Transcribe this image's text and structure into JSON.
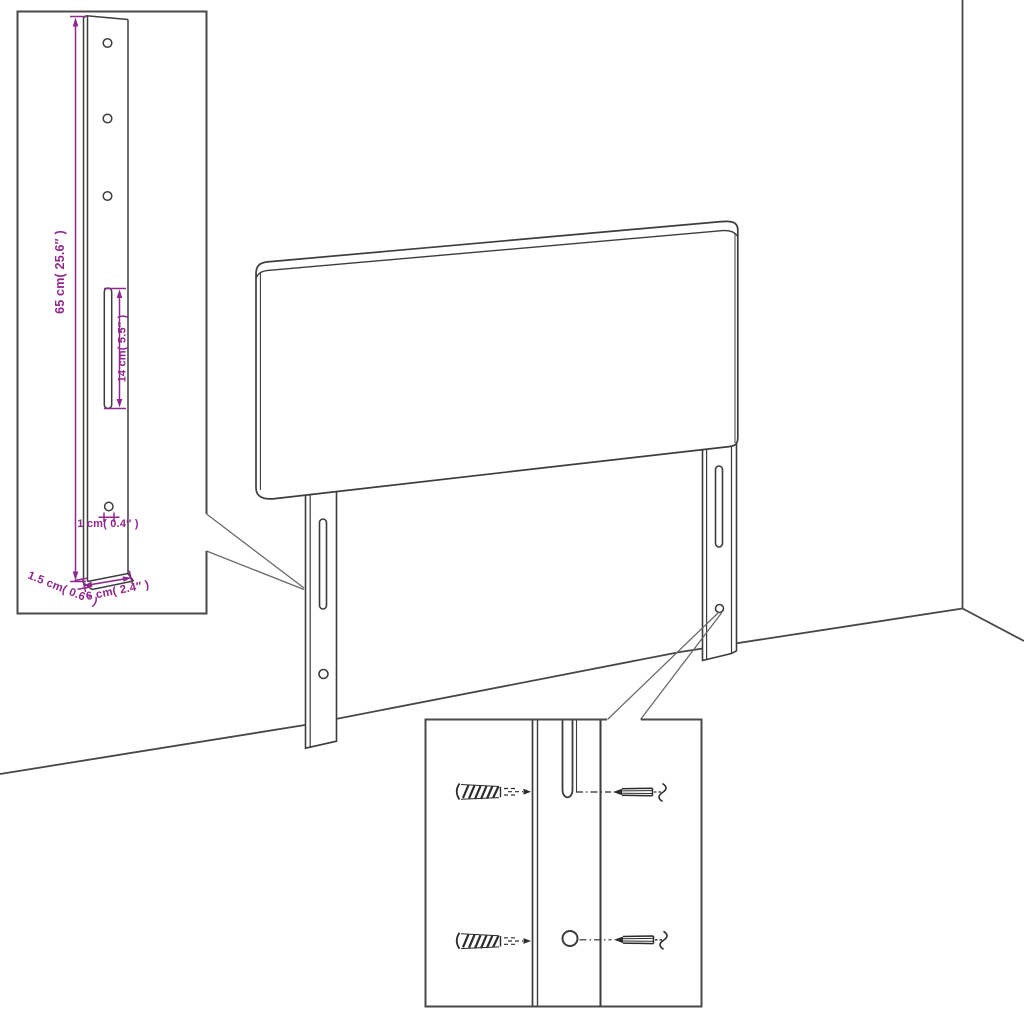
{
  "diagram": {
    "type": "product-assembly-diagram",
    "subject": "upholstered headboard with two slotted wall-mount legs, shown in a room corner",
    "accent_color": "#90278e",
    "line_color": "#3d3d3d",
    "insets": {
      "left_inset": "leg dimension detail",
      "bottom_inset": "wall anchor and screw mounting detail"
    },
    "labels": {
      "leg_height": "65 cm( 25.6″ )",
      "slot_length": "14 cm( 5.5″ )",
      "hole_diameter": "1 cm( 0.4″ )",
      "leg_thickness": "1.5 cm( 0.6″ )",
      "leg_width": "6 cm( 2.4″ )"
    }
  }
}
